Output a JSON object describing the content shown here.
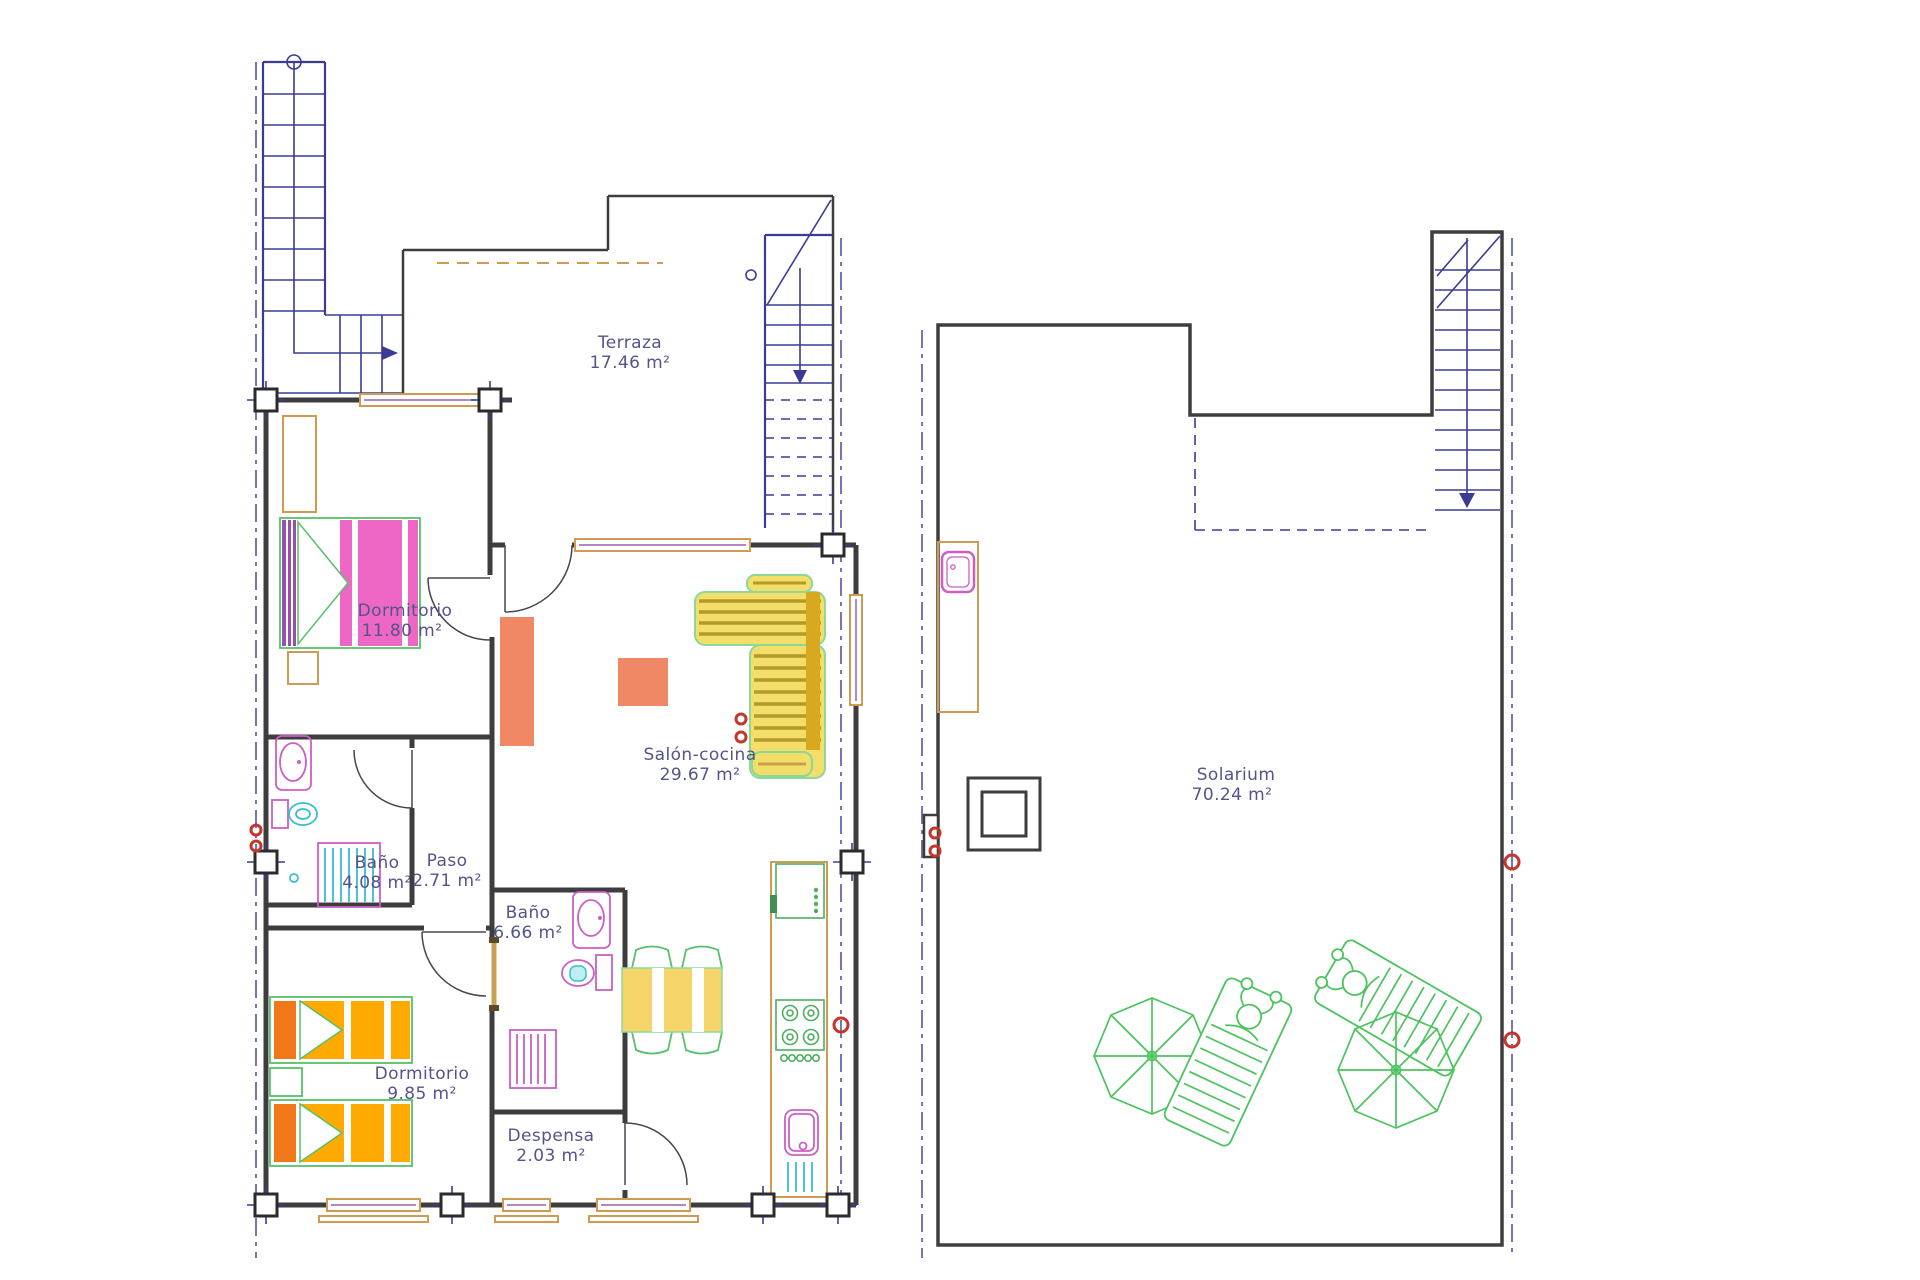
{
  "title": "Apartment floor plan with solarium",
  "rooms": [
    {
      "id": "terraza",
      "name": "Terraza",
      "area": "17.46 m²"
    },
    {
      "id": "dormitorio-1",
      "name": "Dormitorio",
      "area": "11.80 m²"
    },
    {
      "id": "salon-cocina",
      "name": "Salón-cocina",
      "area": "29.67 m²"
    },
    {
      "id": "bano-1",
      "name": "Baño",
      "area": "4.08 m²"
    },
    {
      "id": "paso",
      "name": "Paso",
      "area": "2.71 m²"
    },
    {
      "id": "bano-2",
      "name": "Baño",
      "area": "6.66 m²"
    },
    {
      "id": "dormitorio-2",
      "name": "Dormitorio",
      "area": "9.85 m²"
    },
    {
      "id": "despensa",
      "name": "Despensa",
      "area": "2.03 m²"
    },
    {
      "id": "solarium",
      "name": "Solarium",
      "area": "70.24 m²"
    }
  ],
  "palette": {
    "wall": "#3d3d3d",
    "stairs_axes": "#3b3b96",
    "label_text": "#54548c",
    "window_frame": "#cf9b52",
    "window_inner": "#9a5fb5",
    "bed_pink": "#ee67c4",
    "headboard_purple": "#9a4fae",
    "bed_orange": "#ffaa00",
    "pillow_orange": "#f07818",
    "sofa_yellow": "#f2de68",
    "sofa_stripe": "#b39a2a",
    "sofa_mustard": "#d8a820",
    "salmon_table": "#f08866",
    "fixture_magenta": "#cb5fc4",
    "fixture_cyan": "#38bed2",
    "furniture_green": "#57c06a",
    "lounger_green": "#4cc35e",
    "marker_red": "#c5352c"
  }
}
